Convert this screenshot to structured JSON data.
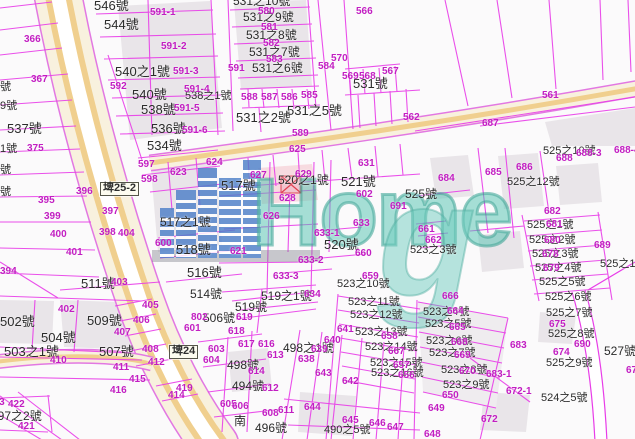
{
  "meta": {
    "type": "cadastral-map-screenshot",
    "width": 635,
    "height": 439
  },
  "watermark": {
    "home": "Home",
    "g": "g"
  },
  "colors": {
    "parcel_line": "#e83ce8",
    "address_text": "#2b2b2b",
    "parcel_code_text": "#c21ec2",
    "road_fill": "#f8f1de",
    "road_stripe": "#f0cf8e",
    "road_border": "#e278e2",
    "building_fill": "#e9e5e9",
    "watermark_blue": "#4d7fc9",
    "watermark_teal": "#52c4b2",
    "red_building": "#e04050"
  },
  "labels": {
    "black": [
      {
        "t": "546號",
        "x": 94,
        "y": -1,
        "s": 13
      },
      {
        "t": "544號",
        "x": 104,
        "y": 18,
        "s": 13
      },
      {
        "t": "540之1號",
        "x": 115,
        "y": 65,
        "s": 13
      },
      {
        "t": "540號",
        "x": 132,
        "y": 88,
        "s": 13
      },
      {
        "t": "538號",
        "x": 141,
        "y": 103,
        "s": 13
      },
      {
        "t": "538之1號",
        "x": 185,
        "y": 91,
        "s": 11
      },
      {
        "t": "536號",
        "x": 151,
        "y": 122,
        "s": 13
      },
      {
        "t": "534號",
        "x": 147,
        "y": 139,
        "s": 13
      },
      {
        "t": "537號",
        "x": 7,
        "y": 122,
        "s": 13
      },
      {
        "t": "531之10號",
        "x": 233,
        "y": -5,
        "s": 12
      },
      {
        "t": "531之9號",
        "x": 243,
        "y": 11,
        "s": 12
      },
      {
        "t": "531之8號",
        "x": 246,
        "y": 29,
        "s": 12
      },
      {
        "t": "531之7號",
        "x": 249,
        "y": 46,
        "s": 12
      },
      {
        "t": "531之6號",
        "x": 252,
        "y": 62,
        "s": 12
      },
      {
        "t": "531之5號",
        "x": 287,
        "y": 104,
        "s": 13
      },
      {
        "t": "531之2號",
        "x": 236,
        "y": 111,
        "s": 13
      },
      {
        "t": "531號",
        "x": 353,
        "y": 77,
        "s": 13
      },
      {
        "t": "號",
        "x": 0,
        "y": 82,
        "s": 11
      },
      {
        "t": "9號",
        "x": 0,
        "y": 101,
        "s": 11
      },
      {
        "t": "1號",
        "x": 0,
        "y": 144,
        "s": 11
      },
      {
        "t": "號",
        "x": 0,
        "y": 165,
        "s": 11
      },
      {
        "t": "號",
        "x": 0,
        "y": 187,
        "s": 11
      },
      {
        "t": "502號",
        "x": 0,
        "y": 315,
        "s": 13
      },
      {
        "t": "509號",
        "x": 87,
        "y": 314,
        "s": 13
      },
      {
        "t": "504號",
        "x": 41,
        "y": 331,
        "s": 13
      },
      {
        "t": "503之1號",
        "x": 4,
        "y": 345,
        "s": 13
      },
      {
        "t": "507號",
        "x": 99,
        "y": 345,
        "s": 13
      },
      {
        "t": "511號",
        "x": 81,
        "y": 277,
        "s": 13
      },
      {
        "t": "516號",
        "x": 187,
        "y": 266,
        "s": 13
      },
      {
        "t": "518號",
        "x": 176,
        "y": 243,
        "s": 13
      },
      {
        "t": "517之1號",
        "x": 160,
        "y": 216,
        "s": 12
      },
      {
        "t": "517號",
        "x": 221,
        "y": 179,
        "s": 13
      },
      {
        "t": "520之1號",
        "x": 278,
        "y": 174,
        "s": 12
      },
      {
        "t": "521號",
        "x": 341,
        "y": 175,
        "s": 13
      },
      {
        "t": "520號",
        "x": 324,
        "y": 238,
        "s": 13
      },
      {
        "t": "525號",
        "x": 405,
        "y": 188,
        "s": 12
      },
      {
        "t": "525之10號",
        "x": 543,
        "y": 146,
        "s": 11
      },
      {
        "t": "525之12號",
        "x": 507,
        "y": 177,
        "s": 11
      },
      {
        "t": "525之1號",
        "x": 527,
        "y": 220,
        "s": 11
      },
      {
        "t": "525之2號",
        "x": 529,
        "y": 235,
        "s": 11
      },
      {
        "t": "525之3號",
        "x": 532,
        "y": 249,
        "s": 11
      },
      {
        "t": "525之4號",
        "x": 535,
        "y": 263,
        "s": 11
      },
      {
        "t": "525之5號",
        "x": 539,
        "y": 277,
        "s": 11
      },
      {
        "t": "525之6號",
        "x": 545,
        "y": 292,
        "s": 11
      },
      {
        "t": "525之7號",
        "x": 546,
        "y": 308,
        "s": 11
      },
      {
        "t": "525之8號",
        "x": 548,
        "y": 329,
        "s": 11
      },
      {
        "t": "525之9號",
        "x": 546,
        "y": 358,
        "s": 11
      },
      {
        "t": "525之1號",
        "x": 600,
        "y": 259,
        "s": 11
      },
      {
        "t": "527號",
        "x": 604,
        "y": 345,
        "s": 12
      },
      {
        "t": "524之5號",
        "x": 541,
        "y": 393,
        "s": 11
      },
      {
        "t": "523之3號",
        "x": 410,
        "y": 245,
        "s": 11
      },
      {
        "t": "523之4號",
        "x": 423,
        "y": 307,
        "s": 11
      },
      {
        "t": "523之5號",
        "x": 425,
        "y": 319,
        "s": 11
      },
      {
        "t": "523之6號",
        "x": 426,
        "y": 336,
        "s": 11
      },
      {
        "t": "523之7號",
        "x": 429,
        "y": 348,
        "s": 11
      },
      {
        "t": "523之8號",
        "x": 441,
        "y": 365,
        "s": 11
      },
      {
        "t": "523之9號",
        "x": 443,
        "y": 380,
        "s": 11
      },
      {
        "t": "523之10號",
        "x": 337,
        "y": 279,
        "s": 11
      },
      {
        "t": "523之11號",
        "x": 348,
        "y": 297,
        "s": 11
      },
      {
        "t": "523之12號",
        "x": 350,
        "y": 310,
        "s": 11
      },
      {
        "t": "523之13號",
        "x": 355,
        "y": 327,
        "s": 11
      },
      {
        "t": "523之14號",
        "x": 365,
        "y": 342,
        "s": 11
      },
      {
        "t": "523之15號",
        "x": 370,
        "y": 358,
        "s": 11
      },
      {
        "t": "523之16號",
        "x": 371,
        "y": 368,
        "s": 11
      },
      {
        "t": "519之1號",
        "x": 261,
        "y": 290,
        "s": 12
      },
      {
        "t": "519號",
        "x": 235,
        "y": 301,
        "s": 12
      },
      {
        "t": "514號",
        "x": 190,
        "y": 288,
        "s": 12
      },
      {
        "t": "506號",
        "x": 203,
        "y": 312,
        "s": 12
      },
      {
        "t": "498之1號",
        "x": 283,
        "y": 342,
        "s": 12
      },
      {
        "t": "498號",
        "x": 227,
        "y": 359,
        "s": 12
      },
      {
        "t": "494號",
        "x": 232,
        "y": 380,
        "s": 12
      },
      {
        "t": "496號",
        "x": 255,
        "y": 422,
        "s": 12
      },
      {
        "t": "490之5號",
        "x": 324,
        "y": 425,
        "s": 11
      },
      {
        "t": "497之2號",
        "x": -9,
        "y": 410,
        "s": 12
      },
      {
        "t": "南",
        "x": 234,
        "y": 415,
        "s": 12
      }
    ],
    "magenta": [
      {
        "t": "366",
        "x": 24,
        "y": 35
      },
      {
        "t": "367",
        "x": 31,
        "y": 75
      },
      {
        "t": "375",
        "x": 27,
        "y": 144
      },
      {
        "t": "394",
        "x": 0,
        "y": 267
      },
      {
        "t": "395",
        "x": 38,
        "y": 196
      },
      {
        "t": "396",
        "x": 76,
        "y": 187
      },
      {
        "t": "397",
        "x": 102,
        "y": 207
      },
      {
        "t": "398",
        "x": 99,
        "y": 228
      },
      {
        "t": "399",
        "x": 44,
        "y": 212
      },
      {
        "t": "400",
        "x": 50,
        "y": 230
      },
      {
        "t": "401",
        "x": 66,
        "y": 248
      },
      {
        "t": "402",
        "x": 58,
        "y": 305
      },
      {
        "t": "403",
        "x": 111,
        "y": 278
      },
      {
        "t": "404",
        "x": 118,
        "y": 229
      },
      {
        "t": "405",
        "x": 142,
        "y": 301
      },
      {
        "t": "406",
        "x": 133,
        "y": 316
      },
      {
        "t": "407",
        "x": 114,
        "y": 328
      },
      {
        "t": "408",
        "x": 142,
        "y": 345
      },
      {
        "t": "410",
        "x": 50,
        "y": 356
      },
      {
        "t": "411",
        "x": 113,
        "y": 363
      },
      {
        "t": "412",
        "x": 148,
        "y": 358
      },
      {
        "t": "413",
        "x": -12,
        "y": 398
      },
      {
        "t": "414",
        "x": 168,
        "y": 391
      },
      {
        "t": "415",
        "x": 129,
        "y": 375
      },
      {
        "t": "416",
        "x": 110,
        "y": 386
      },
      {
        "t": "419",
        "x": 176,
        "y": 384
      },
      {
        "t": "421",
        "x": 18,
        "y": 422
      },
      {
        "t": "422",
        "x": 8,
        "y": 400
      },
      {
        "t": "561",
        "x": 542,
        "y": 91
      },
      {
        "t": "562",
        "x": 403,
        "y": 113
      },
      {
        "t": "566",
        "x": 356,
        "y": 7
      },
      {
        "t": "567",
        "x": 382,
        "y": 67
      },
      {
        "t": "568",
        "x": 359,
        "y": 72
      },
      {
        "t": "569",
        "x": 342,
        "y": 72
      },
      {
        "t": "570",
        "x": 331,
        "y": 54
      },
      {
        "t": "580",
        "x": 258,
        "y": 7
      },
      {
        "t": "581",
        "x": 261,
        "y": 23
      },
      {
        "t": "582",
        "x": 263,
        "y": 39
      },
      {
        "t": "583",
        "x": 266,
        "y": 55
      },
      {
        "t": "584",
        "x": 318,
        "y": 62
      },
      {
        "t": "585",
        "x": 301,
        "y": 91
      },
      {
        "t": "586",
        "x": 281,
        "y": 93
      },
      {
        "t": "587",
        "x": 261,
        "y": 93
      },
      {
        "t": "588",
        "x": 241,
        "y": 93
      },
      {
        "t": "589",
        "x": 292,
        "y": 129
      },
      {
        "t": "591",
        "x": 228,
        "y": 64
      },
      {
        "t": "591-1",
        "x": 150,
        "y": 8
      },
      {
        "t": "591-2",
        "x": 161,
        "y": 42
      },
      {
        "t": "591-3",
        "x": 173,
        "y": 67
      },
      {
        "t": "591-4",
        "x": 184,
        "y": 85
      },
      {
        "t": "591-5",
        "x": 174,
        "y": 104
      },
      {
        "t": "591-6",
        "x": 182,
        "y": 126
      },
      {
        "t": "592",
        "x": 110,
        "y": 82
      },
      {
        "t": "597",
        "x": 138,
        "y": 160
      },
      {
        "t": "598",
        "x": 141,
        "y": 175
      },
      {
        "t": "600",
        "x": 155,
        "y": 239
      },
      {
        "t": "601",
        "x": 184,
        "y": 324
      },
      {
        "t": "602",
        "x": 356,
        "y": 190
      },
      {
        "t": "603",
        "x": 208,
        "y": 345
      },
      {
        "t": "604",
        "x": 203,
        "y": 356
      },
      {
        "t": "605",
        "x": 220,
        "y": 400
      },
      {
        "t": "606",
        "x": 232,
        "y": 402
      },
      {
        "t": "608",
        "x": 262,
        "y": 409
      },
      {
        "t": "611",
        "x": 278,
        "y": 406
      },
      {
        "t": "612",
        "x": 262,
        "y": 384
      },
      {
        "t": "613",
        "x": 267,
        "y": 351
      },
      {
        "t": "614",
        "x": 248,
        "y": 367
      },
      {
        "t": "616",
        "x": 258,
        "y": 340
      },
      {
        "t": "617",
        "x": 238,
        "y": 340
      },
      {
        "t": "618",
        "x": 228,
        "y": 327
      },
      {
        "t": "619",
        "x": 236,
        "y": 313
      },
      {
        "t": "621",
        "x": 230,
        "y": 247
      },
      {
        "t": "623",
        "x": 170,
        "y": 168
      },
      {
        "t": "624",
        "x": 206,
        "y": 158
      },
      {
        "t": "625",
        "x": 289,
        "y": 145
      },
      {
        "t": "626",
        "x": 263,
        "y": 212
      },
      {
        "t": "627",
        "x": 250,
        "y": 171
      },
      {
        "t": "628",
        "x": 279,
        "y": 194
      },
      {
        "t": "629",
        "x": 295,
        "y": 170
      },
      {
        "t": "631",
        "x": 358,
        "y": 159
      },
      {
        "t": "633",
        "x": 353,
        "y": 219
      },
      {
        "t": "633-1",
        "x": 314,
        "y": 229
      },
      {
        "t": "633-2",
        "x": 298,
        "y": 256
      },
      {
        "t": "633-3",
        "x": 273,
        "y": 272
      },
      {
        "t": "634",
        "x": 304,
        "y": 290
      },
      {
        "t": "638",
        "x": 298,
        "y": 355
      },
      {
        "t": "639",
        "x": 311,
        "y": 345
      },
      {
        "t": "640",
        "x": 324,
        "y": 336
      },
      {
        "t": "641",
        "x": 337,
        "y": 325
      },
      {
        "t": "642",
        "x": 342,
        "y": 377
      },
      {
        "t": "643",
        "x": 315,
        "y": 369
      },
      {
        "t": "644",
        "x": 304,
        "y": 403
      },
      {
        "t": "645",
        "x": 342,
        "y": 416
      },
      {
        "t": "646",
        "x": 369,
        "y": 419
      },
      {
        "t": "647",
        "x": 387,
        "y": 423
      },
      {
        "t": "648",
        "x": 424,
        "y": 430
      },
      {
        "t": "649",
        "x": 428,
        "y": 404
      },
      {
        "t": "650",
        "x": 442,
        "y": 391
      },
      {
        "t": "656",
        "x": 398,
        "y": 371
      },
      {
        "t": "657",
        "x": 393,
        "y": 361
      },
      {
        "t": "658",
        "x": 381,
        "y": 332
      },
      {
        "t": "659",
        "x": 362,
        "y": 272
      },
      {
        "t": "660",
        "x": 355,
        "y": 249
      },
      {
        "t": "661",
        "x": 418,
        "y": 225
      },
      {
        "t": "662",
        "x": 425,
        "y": 236
      },
      {
        "t": "664",
        "x": 447,
        "y": 307
      },
      {
        "t": "665",
        "x": 449,
        "y": 323
      },
      {
        "t": "666",
        "x": 442,
        "y": 292
      },
      {
        "t": "667",
        "x": 388,
        "y": 347
      },
      {
        "t": "668",
        "x": 451,
        "y": 338
      },
      {
        "t": "669",
        "x": 454,
        "y": 351
      },
      {
        "t": "670",
        "x": 459,
        "y": 367
      },
      {
        "t": "672",
        "x": 481,
        "y": 415
      },
      {
        "t": "672-1",
        "x": 506,
        "y": 387
      },
      {
        "t": "674",
        "x": 553,
        "y": 348
      },
      {
        "t": "675",
        "x": 549,
        "y": 320
      },
      {
        "t": "676",
        "x": 626,
        "y": 366
      },
      {
        "t": "678",
        "x": 542,
        "y": 250
      },
      {
        "t": "679",
        "x": 543,
        "y": 264
      },
      {
        "t": "680",
        "x": 544,
        "y": 236
      },
      {
        "t": "681",
        "x": 546,
        "y": 220
      },
      {
        "t": "682",
        "x": 544,
        "y": 207
      },
      {
        "t": "683",
        "x": 510,
        "y": 341
      },
      {
        "t": "683-1",
        "x": 486,
        "y": 370
      },
      {
        "t": "684",
        "x": 438,
        "y": 174
      },
      {
        "t": "685",
        "x": 485,
        "y": 168
      },
      {
        "t": "686",
        "x": 516,
        "y": 163
      },
      {
        "t": "687",
        "x": 482,
        "y": 119
      },
      {
        "t": "688",
        "x": 556,
        "y": 154
      },
      {
        "t": "688-3",
        "x": 576,
        "y": 149
      },
      {
        "t": "688-4",
        "x": 614,
        "y": 146
      },
      {
        "t": "689",
        "x": 594,
        "y": 241
      },
      {
        "t": "690",
        "x": 574,
        "y": 340
      },
      {
        "t": "691",
        "x": 390,
        "y": 202
      },
      {
        "t": "802",
        "x": 191,
        "y": 313
      }
    ],
    "boxed": [
      {
        "t": "埤25-2",
        "x": 100,
        "y": 182
      },
      {
        "t": "埤24",
        "x": 169,
        "y": 345
      }
    ]
  }
}
